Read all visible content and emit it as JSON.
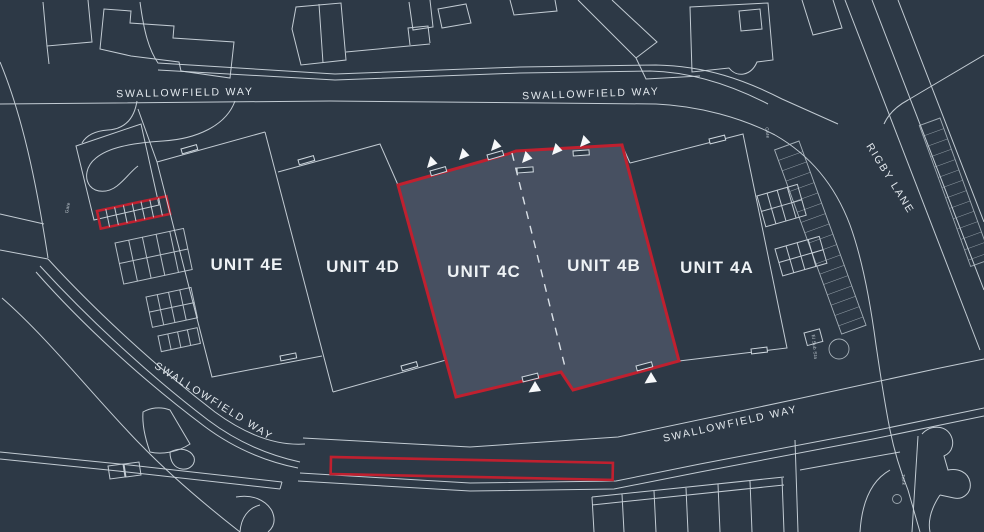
{
  "title": "Industrial estate site plan",
  "colors": {
    "bg": "#2d3946",
    "line": "#cfd8df",
    "fill-hl": "#475061",
    "red": "#c0202f",
    "label": "#eef2f5",
    "street": "#e3e9ee"
  },
  "map": {
    "streets": {
      "swallowfield_way": "SWALLOWFIELD WAY",
      "rigby_lane": "RIGBY LANE"
    },
    "units": [
      {
        "id": "unit-4e",
        "label": "UNIT 4E",
        "highlighted": false
      },
      {
        "id": "unit-4d",
        "label": "UNIT 4D",
        "highlighted": false
      },
      {
        "id": "unit-4c",
        "label": "UNIT 4C",
        "highlighted": true
      },
      {
        "id": "unit-4b",
        "label": "UNIT 4B",
        "highlighted": true
      },
      {
        "id": "unit-4a",
        "label": "UNIT 4A",
        "highlighted": false
      }
    ],
    "micro_labels": {
      "gate": "Gate",
      "el_sub_sta": "El Sub Sta",
      "tank": "Tank"
    }
  }
}
